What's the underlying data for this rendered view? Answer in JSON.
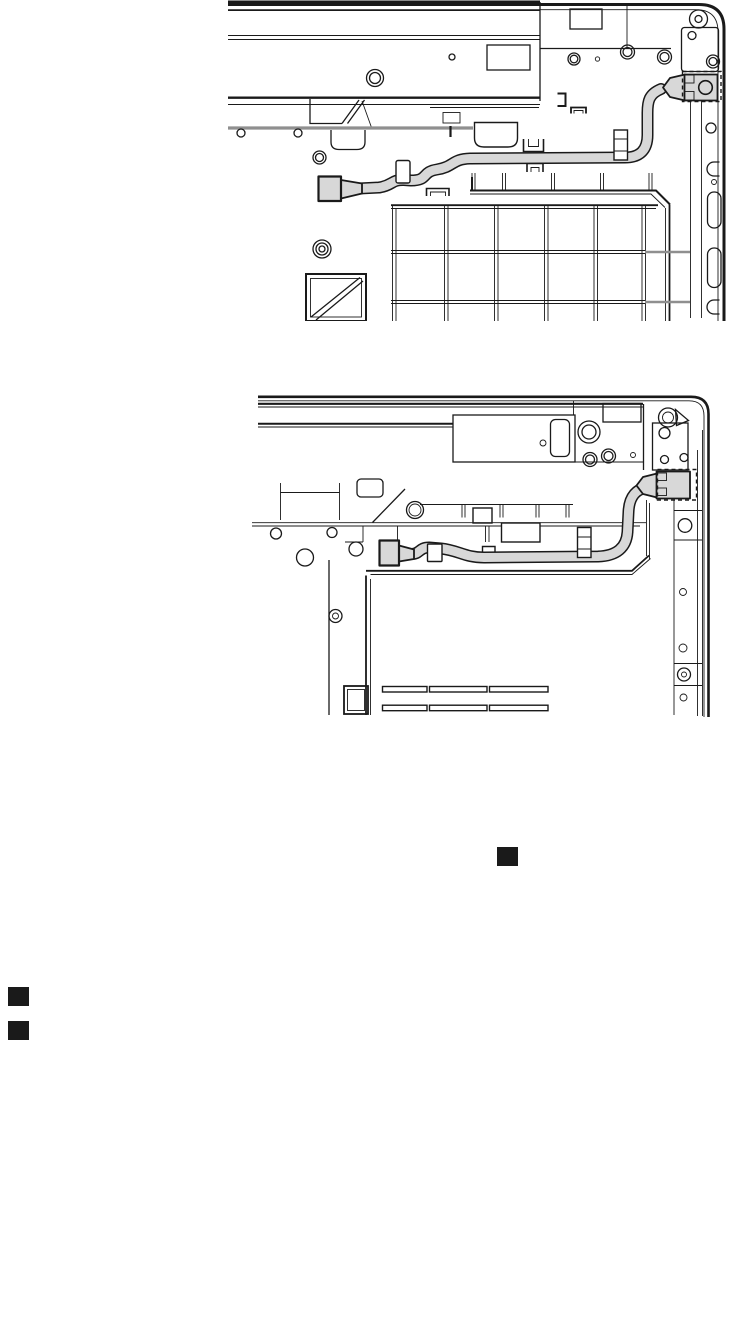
{
  "page": {
    "background": "#ffffff"
  },
  "colors": {
    "ink": "#1a1a1a",
    "cable": "#d8d8d8",
    "grayline": "#8f8f8f",
    "page_bg": "#ffffff"
  },
  "figures": [
    {
      "name": "dc-in-cable-routing-keyboard-side-view"
    },
    {
      "name": "dc-in-cable-routing-bottom-cover-view"
    }
  ],
  "markers": {
    "inline_square": {
      "glyph": "black-square"
    },
    "list_squares": [
      {
        "glyph": "black-square"
      },
      {
        "glyph": "black-square"
      }
    ]
  }
}
